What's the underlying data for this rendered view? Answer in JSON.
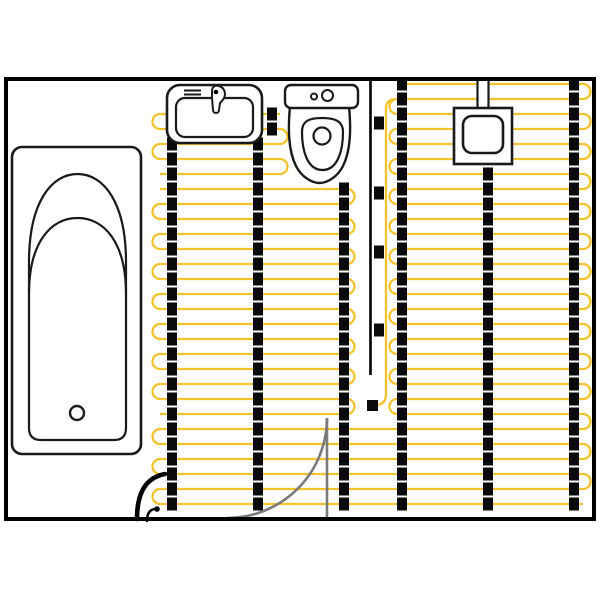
{
  "diagram": {
    "type": "floor-plan",
    "subject": "bathroom-electric-underfloor-heating-layout",
    "canvas": {
      "w": 600,
      "h": 600,
      "bg": "#ffffff"
    },
    "colors": {
      "wall": "#000000",
      "cable": "#F3C22D",
      "busbar": "#0A0A0A",
      "stroke": "#1a1a1a",
      "fill": "#ffffff",
      "door": "#7A7A7A"
    },
    "room": {
      "x": 6,
      "y": 79,
      "w": 588,
      "h": 440,
      "stroke_width": 4
    },
    "heating": {
      "row_spacing": 15,
      "cable_width": 2.3,
      "loop_radius": 7.5,
      "square": {
        "w": 10,
        "h": 13
      },
      "sections": [
        {
          "name": "right-mat",
          "x1": 397,
          "x2": 583,
          "y1": 84,
          "y2": 414,
          "left_pair_start": 1,
          "right_pair_start": 0
        },
        {
          "name": "left-mat-upper",
          "x1": 160,
          "x2": 280,
          "y1": 114,
          "y2": 174,
          "left_pair_start": 0,
          "right_pair_start": 1
        },
        {
          "name": "left-mat-main",
          "x1": 160,
          "x2": 347,
          "y1": 189,
          "y2": 414,
          "left_pair_start": 1,
          "right_pair_start": 0
        },
        {
          "name": "bottom-mat",
          "x1": 160,
          "x2": 583,
          "y1": 429,
          "y2": 504,
          "left_pair_start": 0,
          "right_pair_start": 1
        }
      ],
      "stitch_loops": [
        {
          "side": "right",
          "x": 583,
          "y1": 414,
          "y2": 429
        }
      ],
      "busbars": [
        {
          "x": 172,
          "y1": 114,
          "y2": 504
        },
        {
          "x": 258,
          "y1": 114,
          "y2": 504,
          "alt_x": 272,
          "alt_below_y": 140
        },
        {
          "x": 344,
          "y1": 189,
          "y2": 504
        },
        {
          "x": 402,
          "y1": 84,
          "y2": 504
        },
        {
          "x": 488,
          "y1": 174,
          "y2": 504
        },
        {
          "x": 574,
          "y1": 84,
          "y2": 504
        }
      ],
      "feed_line": {
        "d": "M 397 99 Q 386 99 386 108 L 386 394 Q 386 404 377 405"
      },
      "clips": [
        {
          "cx": 379,
          "cy": 123
        },
        {
          "cx": 379,
          "cy": 193
        },
        {
          "cx": 379,
          "cy": 252
        },
        {
          "cx": 379,
          "cy": 330
        }
      ],
      "end_connector": {
        "x": 367,
        "y": 400,
        "w": 11,
        "h": 11
      },
      "divider": {
        "x": 370.5,
        "y1": 81,
        "y2": 375,
        "stroke_width": 2.6
      }
    },
    "door": {
      "leaf": "M 327 418 L 327 518",
      "swing": "M 227 518 A 100 100 0 0 0 327 418",
      "stroke_width": 2.6
    },
    "power_lead": {
      "main": "M 137 519 C 137 497 143 478 165 474",
      "main_width": 4.6,
      "sensor_lead": "M 147 521 C 147 513 150 509 156 509",
      "sensor_width": 2.4,
      "dot": {
        "cx": 157,
        "cy": 509,
        "r": 2.8
      }
    },
    "fixtures": {
      "bathtub": [
        {
          "t": "rect",
          "x": 12,
          "y": 147,
          "w": 129,
          "h": 307,
          "rx": 10,
          "sw": 2.6
        },
        {
          "t": "path",
          "d": "M 29 262 L 29 428 Q 29 440 41 440 L 114 440 Q 126 440 126 428 L 126 262 C 126 203 104 174 77.5 174 C 51 174 29 203 29 262 Z",
          "sw": 2.2
        },
        {
          "t": "path",
          "d": "M 29 294 C 29 242 51 218 77.5 218 C 104 218 126 242 126 294",
          "sw": 2.2,
          "fill": "none"
        },
        {
          "t": "circle",
          "cx": 77,
          "cy": 413,
          "r": 7,
          "sw": 2.4
        }
      ],
      "sink": [
        {
          "t": "rect",
          "x": 167,
          "y": 85,
          "w": 95,
          "h": 58,
          "rx": 13,
          "sw": 2.6
        },
        {
          "t": "rect",
          "x": 176,
          "y": 98,
          "w": 77,
          "h": 39,
          "rx": 9,
          "sw": 2.2
        },
        {
          "t": "line",
          "x1": 184,
          "y1": 90.5,
          "x2": 201,
          "y2": 90.5,
          "sw": 2
        },
        {
          "t": "line",
          "x1": 184,
          "y1": 94.5,
          "x2": 201,
          "y2": 94.5,
          "sw": 2
        },
        {
          "t": "path",
          "d": "M 212 91 C 212 86 216 85 219 86 C 225 88 226 94 224 98 C 223 100 221 102 220 103 L 219 110 C 219 114 213 114 213 110 L 212 98 Z",
          "sw": 2
        },
        {
          "t": "circle",
          "cx": 216,
          "cy": 92,
          "r": 2.3,
          "fill": "#000000",
          "sw": 0
        }
      ],
      "toilet": [
        {
          "t": "path",
          "d": "M 290 106 C 288 128 288 150 296 166 C 302 178 313 183 319.5 183 C 326 183 337 178 343 166 C 351 150 351 128 349 106 Z",
          "sw": 2.4
        },
        {
          "t": "path",
          "d": "M 302 132 C 302 121 309 118 322 118 C 335 118 343 121 343 132 C 343 150 338 170 322.5 170 C 307 170 302 150 302 132 Z",
          "sw": 2.2
        },
        {
          "t": "circle",
          "cx": 322,
          "cy": 136,
          "r": 8.5,
          "sw": 2.2
        },
        {
          "t": "rect",
          "x": 285,
          "y": 85,
          "w": 73,
          "h": 23,
          "rx": 6,
          "sw": 2.4
        },
        {
          "t": "circle",
          "cx": 314,
          "cy": 96.5,
          "r": 3,
          "sw": 2
        },
        {
          "t": "circle",
          "cx": 327.5,
          "cy": 95.5,
          "r": 5.5,
          "sw": 2
        }
      ],
      "sensor": [
        {
          "t": "rect",
          "x": 478,
          "y": 77,
          "w": 10,
          "h": 31,
          "fill": "#ffffff",
          "sw": 0
        },
        {
          "t": "line",
          "x1": 477.5,
          "y1": 77,
          "x2": 477.5,
          "y2": 108,
          "sw": 2.2
        },
        {
          "t": "line",
          "x1": 488.5,
          "y1": 77,
          "x2": 488.5,
          "y2": 108,
          "sw": 2.2
        },
        {
          "t": "rect",
          "x": 454,
          "y": 108,
          "w": 58,
          "h": 56,
          "sw": 2.6
        },
        {
          "t": "rect",
          "x": 463,
          "y": 116,
          "w": 40,
          "h": 37,
          "rx": 9,
          "sw": 2.6
        }
      ]
    }
  }
}
